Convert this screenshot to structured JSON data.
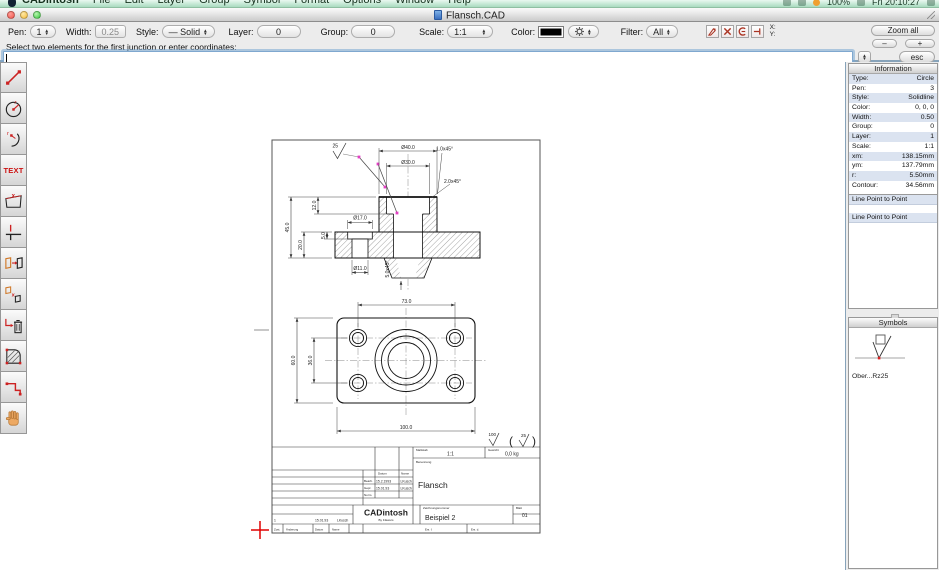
{
  "menubar": {
    "items": [
      "CADintosh",
      "File",
      "Edit",
      "Layer",
      "Group",
      "Symbol",
      "Format",
      "Options",
      "Window",
      "Help"
    ],
    "status": {
      "battery": "100%",
      "clock": "Fri 20:10:27"
    }
  },
  "window": {
    "title": "Flansch.CAD"
  },
  "toolbar": {
    "pen_label": "Pen:",
    "pen_value": "1",
    "width_label": "Width:",
    "width_value": "0.25",
    "style_label": "Style:",
    "style_value": "— Solid",
    "layer_label": "Layer:",
    "layer_value": "0",
    "group_label": "Group:",
    "group_value": "0",
    "scale_label": "Scale:",
    "scale_value": "1:1",
    "color_label": "Color:",
    "filter_label": "Filter:",
    "filter_value": "All",
    "x_label": "X:",
    "y_label": "Y:",
    "zoom_all": "Zoom all",
    "zoom_out": "–",
    "zoom_in": "+",
    "esc": "esc"
  },
  "command": {
    "prompt": "Select two elements for the first junction or enter coordinates:",
    "value": ""
  },
  "tools": {
    "text_label": "TEXT"
  },
  "info": {
    "title": "Information",
    "rows": [
      {
        "label": "Type:",
        "value": "Circle"
      },
      {
        "label": "Pen:",
        "value": "3"
      },
      {
        "label": "Style:",
        "value": "Solidline"
      },
      {
        "label": "Color:",
        "value": "0, 0, 0"
      },
      {
        "label": "Width:",
        "value": "0.50"
      },
      {
        "label": "Group:",
        "value": "0"
      },
      {
        "label": "Layer:",
        "value": "1"
      },
      {
        "label": "Scale:",
        "value": "1:1"
      },
      {
        "label": "xm:",
        "value": "138.15mm"
      },
      {
        "label": "ym:",
        "value": "137.79mm"
      },
      {
        "label": "r:",
        "value": "5.50mm"
      },
      {
        "label": "Contour:",
        "value": "34.56mm"
      }
    ],
    "history": [
      "Line Point to Point",
      "Line Point to Point"
    ]
  },
  "symbols": {
    "title": "Symbols",
    "item_label": "Ober...Rz25"
  },
  "drawing": {
    "dims": {
      "d40": "Ø40.0",
      "d30": "Ø30.0",
      "ch1": "1.0x45°",
      "ch2": "2.0x45°",
      "d17": "Ø17.0",
      "d11": "Ø11.0",
      "v12": "12.0",
      "v45": "45.0",
      "v20": "20.0",
      "v5": "5.0",
      "ch5": "5.0x45°",
      "w73": "73.0",
      "w100": "100.0",
      "h60": "60.0",
      "h36": "36.0",
      "surf_top": "25",
      "surf_100": "100",
      "surf_25": "25",
      "paren_open": "(",
      "paren_close": ")"
    },
    "title_block": {
      "scale_label": "Maßstab",
      "scale": "1:1",
      "weight_label": "Gewicht",
      "weight": "0,0 kg",
      "date_label": "Datum",
      "name_label": "Name",
      "bearb_label": "Bearb.",
      "gepr_label": "Gepr.",
      "norm_label": "Norm.",
      "bearb_date": "15.2.1993",
      "bearb_name": "LKusch",
      "gepr_date": "15.01.93",
      "gepr_name": "LKusch",
      "benennung_label": "Benennung",
      "part_name": "Flansch",
      "app_name": "CADintosh",
      "app_sub": "By F.Ewers",
      "dwgno_label": "Zeichnungsnummer",
      "dwg_no": "Beispiel 2",
      "sheet_label": "Blatt",
      "sheet": "01",
      "chg_no": "1",
      "chg_date": "15.01.93",
      "chg_name": "LKusch",
      "zust_label": "Zust.",
      "aend_label": "Änderung",
      "datum2_label": "Datum",
      "name2_label": "Name",
      "ersf_label": "Ers. f.",
      "ersd_label": "Ers. d."
    }
  }
}
